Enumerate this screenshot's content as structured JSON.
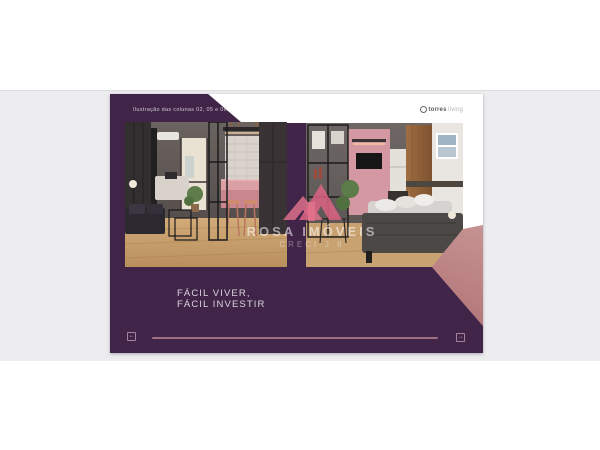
{
  "window": {
    "background": "#ffffff",
    "band_color": "#ededef"
  },
  "slide": {
    "caption": "Ilustração das colunas 02, 05 e 06",
    "brand": {
      "icon": "circle-logo-icon",
      "name": "torres",
      "suffix": "living"
    },
    "headline": {
      "line1": "FÁCIL VIVER,",
      "line2": "FÁCIL INVESTIR"
    },
    "watermark": {
      "icon": "house-roofs-icon",
      "name": "ROSA IMÓVEIS",
      "registration": "CRECI-J 8"
    },
    "nav": {
      "prev_symbol": "←",
      "next_symbol": "→"
    },
    "colors": {
      "purple": "#402549",
      "rose_light": "#d6aea6",
      "rose_dark": "#a2656c",
      "progress_bar": "#9d7183",
      "headline_text": "#dcd5e0"
    },
    "photos": [
      {
        "label": "living room with pink kitchen counter render"
      },
      {
        "label": "bedroom with pink wall and wood panel render"
      }
    ]
  }
}
